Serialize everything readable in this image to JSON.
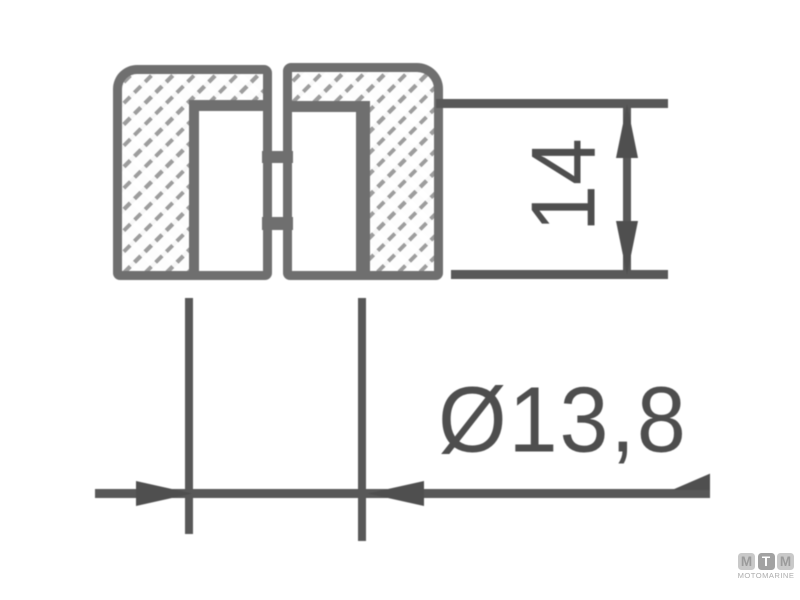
{
  "drawing": {
    "dimensions": {
      "height": {
        "value": "14"
      },
      "diameter": {
        "value": "Ø13,8"
      }
    },
    "colors": {
      "outline": "#6f6f6f",
      "hatch": "#9d9d9d",
      "dimension_lines": "#585858",
      "label_text": "#4e4e4e",
      "background": "#ffffff",
      "watermark_gray": "#adadad"
    }
  },
  "watermark": {
    "tiles": [
      "M",
      "T",
      "M"
    ],
    "subtitle": "MOTOMARINE"
  }
}
